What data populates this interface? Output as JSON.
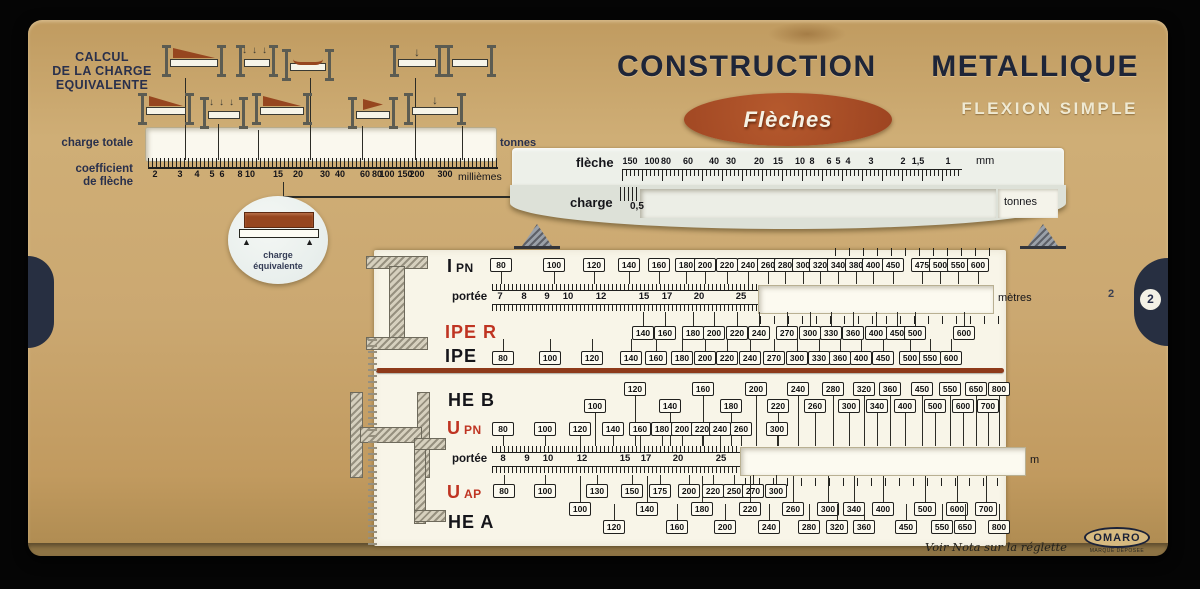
{
  "colors": {
    "card": "#cba871",
    "navy": "#1e2538",
    "badge_red": "#9d4421",
    "label_red": "#bf3422",
    "panel": "#f8f5e8"
  },
  "header": {
    "title_1": "CONSTRUCTION",
    "title_2": "METALLIQUE",
    "badge": "Flèches",
    "subtitle": "FLEXION SIMPLE"
  },
  "equiv": {
    "title_lines": [
      "CALCUL",
      "DE LA CHARGE",
      "EQUIVALENTE"
    ],
    "charge_totale": "charge totale",
    "tonnes": "tonnes",
    "coeff_line1": "coefficient",
    "coeff_line2": "de flèche",
    "unit": "millièmes",
    "scale": [
      {
        "v": "2",
        "x": 155
      },
      {
        "v": "3",
        "x": 180
      },
      {
        "v": "4",
        "x": 197
      },
      {
        "v": "5",
        "x": 212
      },
      {
        "v": "6",
        "x": 222
      },
      {
        "v": "8",
        "x": 240
      },
      {
        "v": "10",
        "x": 250
      },
      {
        "v": "15",
        "x": 278
      },
      {
        "v": "20",
        "x": 298
      },
      {
        "v": "30",
        "x": 325
      },
      {
        "v": "40",
        "x": 340
      },
      {
        "v": "60",
        "x": 365
      },
      {
        "v": "80",
        "x": 377
      },
      {
        "v": "100",
        "x": 387
      },
      {
        "v": "150",
        "x": 405
      },
      {
        "v": "200",
        "x": 417
      },
      {
        "v": "300",
        "x": 445
      }
    ],
    "circle": [
      "charge",
      "équivalente"
    ]
  },
  "slider": {
    "fleche": "flèche",
    "mm": "mm",
    "charge": "charge",
    "charge_value": "0,5",
    "tonnes": "tonnes",
    "scale": [
      {
        "v": "150",
        "x": 630
      },
      {
        "v": "100",
        "x": 652
      },
      {
        "v": "80",
        "x": 666
      },
      {
        "v": "60",
        "x": 688
      },
      {
        "v": "40",
        "x": 714
      },
      {
        "v": "30",
        "x": 731
      },
      {
        "v": "20",
        "x": 759
      },
      {
        "v": "15",
        "x": 778
      },
      {
        "v": "10",
        "x": 800
      },
      {
        "v": "8",
        "x": 812
      },
      {
        "v": "6",
        "x": 829
      },
      {
        "v": "5",
        "x": 838
      },
      {
        "v": "4",
        "x": 848
      },
      {
        "v": "3",
        "x": 871
      },
      {
        "v": "2",
        "x": 903
      },
      {
        "v": "1,5",
        "x": 918
      },
      {
        "v": "1",
        "x": 948
      }
    ]
  },
  "load_cases": [
    {
      "x": 162,
      "y": 44,
      "w": 64,
      "t": "tri"
    },
    {
      "x": 236,
      "y": 44,
      "w": 42,
      "t": "arrows"
    },
    {
      "x": 282,
      "y": 48,
      "w": 52,
      "t": "curve"
    },
    {
      "x": 390,
      "y": 44,
      "w": 54,
      "t": "point"
    },
    {
      "x": 444,
      "y": 44,
      "w": 52,
      "t": "plain"
    },
    {
      "x": 138,
      "y": 92,
      "w": 56,
      "t": "tri"
    },
    {
      "x": 200,
      "y": 96,
      "w": 48,
      "t": "arrows"
    },
    {
      "x": 252,
      "y": 92,
      "w": 60,
      "t": "tri"
    },
    {
      "x": 348,
      "y": 96,
      "w": 50,
      "t": "wedge"
    },
    {
      "x": 404,
      "y": 92,
      "w": 62,
      "t": "point"
    }
  ],
  "panel": {
    "rows": [
      {
        "kind": "boxes",
        "label": {
          "big": "I",
          "small": "PN",
          "color": "black",
          "x": 447,
          "y": 256
        },
        "y": 258,
        "stem": "down",
        "stem_len": 13,
        "items": [
          {
            "v": "80",
            "x": 501
          },
          {
            "v": "100",
            "x": 554
          },
          {
            "v": "120",
            "x": 594
          },
          {
            "v": "140",
            "x": 629
          },
          {
            "v": "160",
            "x": 659
          },
          {
            "v": "180",
            "x": 686
          },
          {
            "v": "200",
            "x": 705
          },
          {
            "v": "220",
            "x": 727
          },
          {
            "v": "240",
            "x": 748
          },
          {
            "v": "260",
            "x": 768
          },
          {
            "v": "280",
            "x": 785
          },
          {
            "v": "300",
            "x": 803
          },
          {
            "v": "320",
            "x": 820
          },
          {
            "v": "340",
            "x": 838
          },
          {
            "v": "380",
            "x": 856
          },
          {
            "v": "400",
            "x": 873
          },
          {
            "v": "450",
            "x": 893
          },
          {
            "v": "475",
            "x": 922
          },
          {
            "v": "500",
            "x": 940
          },
          {
            "v": "550",
            "x": 958
          },
          {
            "v": "600",
            "x": 978
          }
        ]
      },
      {
        "kind": "ruler",
        "label": {
          "text": "portée",
          "x": 452,
          "y": 291
        },
        "y": 284,
        "x1": 492,
        "x2": 758,
        "nums": [
          {
            "v": "7",
            "x": 500
          },
          {
            "v": "8",
            "x": 524
          },
          {
            "v": "9",
            "x": 547
          },
          {
            "v": "10",
            "x": 568
          },
          {
            "v": "12",
            "x": 601
          },
          {
            "v": "15",
            "x": 644
          },
          {
            "v": "17",
            "x": 667
          },
          {
            "v": "20",
            "x": 699
          },
          {
            "v": "25",
            "x": 741
          }
        ],
        "unit": {
          "text": "mètres",
          "x": 998
        },
        "window": {
          "x": 758,
          "w": 234
        }
      },
      {
        "kind": "boxes",
        "label": {
          "big": "IPE R",
          "small": "",
          "color": "red",
          "x": 445,
          "y": 322
        },
        "y": 326,
        "stem": "up",
        "stem_len": 14,
        "items": [
          {
            "v": "140",
            "x": 643
          },
          {
            "v": "160",
            "x": 665
          },
          {
            "v": "180",
            "x": 693
          },
          {
            "v": "200",
            "x": 714
          },
          {
            "v": "220",
            "x": 737
          },
          {
            "v": "240",
            "x": 759
          },
          {
            "v": "270",
            "x": 787
          },
          {
            "v": "300",
            "x": 810
          },
          {
            "v": "330",
            "x": 831
          },
          {
            "v": "360",
            "x": 853
          },
          {
            "v": "400",
            "x": 876
          },
          {
            "v": "450",
            "x": 897
          },
          {
            "v": "500",
            "x": 915
          },
          {
            "v": "600",
            "x": 964
          }
        ]
      },
      {
        "kind": "boxes",
        "label": {
          "big": "IPE",
          "small": "",
          "color": "black",
          "x": 445,
          "y": 346
        },
        "y": 351,
        "stem": "up",
        "stem_len": 12,
        "items": [
          {
            "v": "80",
            "x": 503
          },
          {
            "v": "100",
            "x": 550
          },
          {
            "v": "120",
            "x": 592
          },
          {
            "v": "140",
            "x": 631
          },
          {
            "v": "160",
            "x": 656
          },
          {
            "v": "180",
            "x": 682
          },
          {
            "v": "200",
            "x": 705
          },
          {
            "v": "220",
            "x": 727
          },
          {
            "v": "240",
            "x": 750
          },
          {
            "v": "270",
            "x": 774
          },
          {
            "v": "300",
            "x": 797
          },
          {
            "v": "330",
            "x": 819
          },
          {
            "v": "360",
            "x": 840
          },
          {
            "v": "400",
            "x": 861
          },
          {
            "v": "450",
            "x": 883
          },
          {
            "v": "500",
            "x": 910
          },
          {
            "v": "550",
            "x": 930
          },
          {
            "v": "600",
            "x": 951
          }
        ]
      },
      {
        "kind": "tiers",
        "label": {
          "big": "HE B",
          "small": "",
          "color": "black",
          "x": 448,
          "y": 390
        },
        "tiers": [
          {
            "y": 382,
            "stem": "down",
            "stem_len": 51,
            "items": [
              {
                "v": "120",
                "x": 635
              },
              {
                "v": "160",
                "x": 703
              },
              {
                "v": "200",
                "x": 756
              },
              {
                "v": "240",
                "x": 798
              },
              {
                "v": "280",
                "x": 833
              },
              {
                "v": "320",
                "x": 864
              },
              {
                "v": "360",
                "x": 890
              },
              {
                "v": "450",
                "x": 922
              },
              {
                "v": "550",
                "x": 950
              },
              {
                "v": "650",
                "x": 976
              },
              {
                "v": "800",
                "x": 999
              }
            ]
          },
          {
            "y": 399,
            "stem": "down",
            "stem_len": 34,
            "items": [
              {
                "v": "100",
                "x": 595
              },
              {
                "v": "140",
                "x": 670
              },
              {
                "v": "180",
                "x": 731
              },
              {
                "v": "220",
                "x": 778
              },
              {
                "v": "260",
                "x": 815
              },
              {
                "v": "300",
                "x": 849
              },
              {
                "v": "340",
                "x": 877
              },
              {
                "v": "400",
                "x": 905
              },
              {
                "v": "500",
                "x": 935
              },
              {
                "v": "600",
                "x": 963
              },
              {
                "v": "700",
                "x": 988
              }
            ]
          }
        ]
      },
      {
        "kind": "boxes",
        "label": {
          "big": "U",
          "small": "PN",
          "color": "red",
          "x": 447,
          "y": 418
        },
        "y": 422,
        "stem": "down",
        "stem_len": 11,
        "items": [
          {
            "v": "80",
            "x": 503
          },
          {
            "v": "100",
            "x": 545
          },
          {
            "v": "120",
            "x": 580
          },
          {
            "v": "140",
            "x": 613
          },
          {
            "v": "160",
            "x": 640
          },
          {
            "v": "180",
            "x": 662
          },
          {
            "v": "200",
            "x": 682
          },
          {
            "v": "220",
            "x": 702
          },
          {
            "v": "240",
            "x": 720
          },
          {
            "v": "260",
            "x": 741
          },
          {
            "v": "300",
            "x": 777
          }
        ]
      },
      {
        "kind": "ruler",
        "label": {
          "text": "portée",
          "x": 452,
          "y": 453
        },
        "y": 446,
        "x1": 492,
        "x2": 740,
        "nums": [
          {
            "v": "8",
            "x": 503
          },
          {
            "v": "9",
            "x": 527
          },
          {
            "v": "10",
            "x": 548
          },
          {
            "v": "12",
            "x": 582
          },
          {
            "v": "15",
            "x": 625
          },
          {
            "v": "17",
            "x": 646
          },
          {
            "v": "20",
            "x": 678
          },
          {
            "v": "25",
            "x": 721
          }
        ],
        "unit": {
          "text": "m",
          "x": 1030
        },
        "window": {
          "x": 740,
          "w": 284
        }
      },
      {
        "kind": "boxes",
        "label": {
          "big": "U",
          "small": "AP",
          "color": "red",
          "x": 447,
          "y": 482
        },
        "y": 484,
        "stem": "up",
        "stem_len": 9,
        "items": [
          {
            "v": "80",
            "x": 504
          },
          {
            "v": "100",
            "x": 545
          },
          {
            "v": "130",
            "x": 597
          },
          {
            "v": "150",
            "x": 632
          },
          {
            "v": "175",
            "x": 660
          },
          {
            "v": "200",
            "x": 689
          },
          {
            "v": "220",
            "x": 713
          },
          {
            "v": "250",
            "x": 734
          },
          {
            "v": "270",
            "x": 753
          },
          {
            "v": "300",
            "x": 776
          }
        ]
      },
      {
        "kind": "tiers",
        "label": {
          "big": "HE A",
          "small": "",
          "color": "black",
          "x": 448,
          "y": 512
        },
        "tiers": [
          {
            "y": 502,
            "stem": "up",
            "stem_len": 26,
            "items": [
              {
                "v": "100",
                "x": 580
              },
              {
                "v": "140",
                "x": 647
              },
              {
                "v": "180",
                "x": 702
              },
              {
                "v": "220",
                "x": 750
              },
              {
                "v": "260",
                "x": 793
              },
              {
                "v": "300",
                "x": 828
              },
              {
                "v": "340",
                "x": 854
              },
              {
                "v": "400",
                "x": 883
              },
              {
                "v": "500",
                "x": 925
              },
              {
                "v": "600",
                "x": 957
              },
              {
                "v": "700",
                "x": 986
              }
            ]
          },
          {
            "y": 520,
            "stem": "up",
            "stem_len": 16,
            "items": [
              {
                "v": "120",
                "x": 614
              },
              {
                "v": "160",
                "x": 677
              },
              {
                "v": "200",
                "x": 725
              },
              {
                "v": "240",
                "x": 769
              },
              {
                "v": "280",
                "x": 809
              },
              {
                "v": "320",
                "x": 837
              },
              {
                "v": "360",
                "x": 864
              },
              {
                "v": "450",
                "x": 906
              },
              {
                "v": "550",
                "x": 942
              },
              {
                "v": "650",
                "x": 965
              },
              {
                "v": "800",
                "x": 999
              }
            ]
          }
        ]
      }
    ]
  },
  "footer": {
    "nota": "Voir Nota sur la réglette",
    "brand": "OMARO",
    "brand_sub": "MARQUE DEPOSEE"
  },
  "page": {
    "number": "2",
    "notch": "2"
  }
}
